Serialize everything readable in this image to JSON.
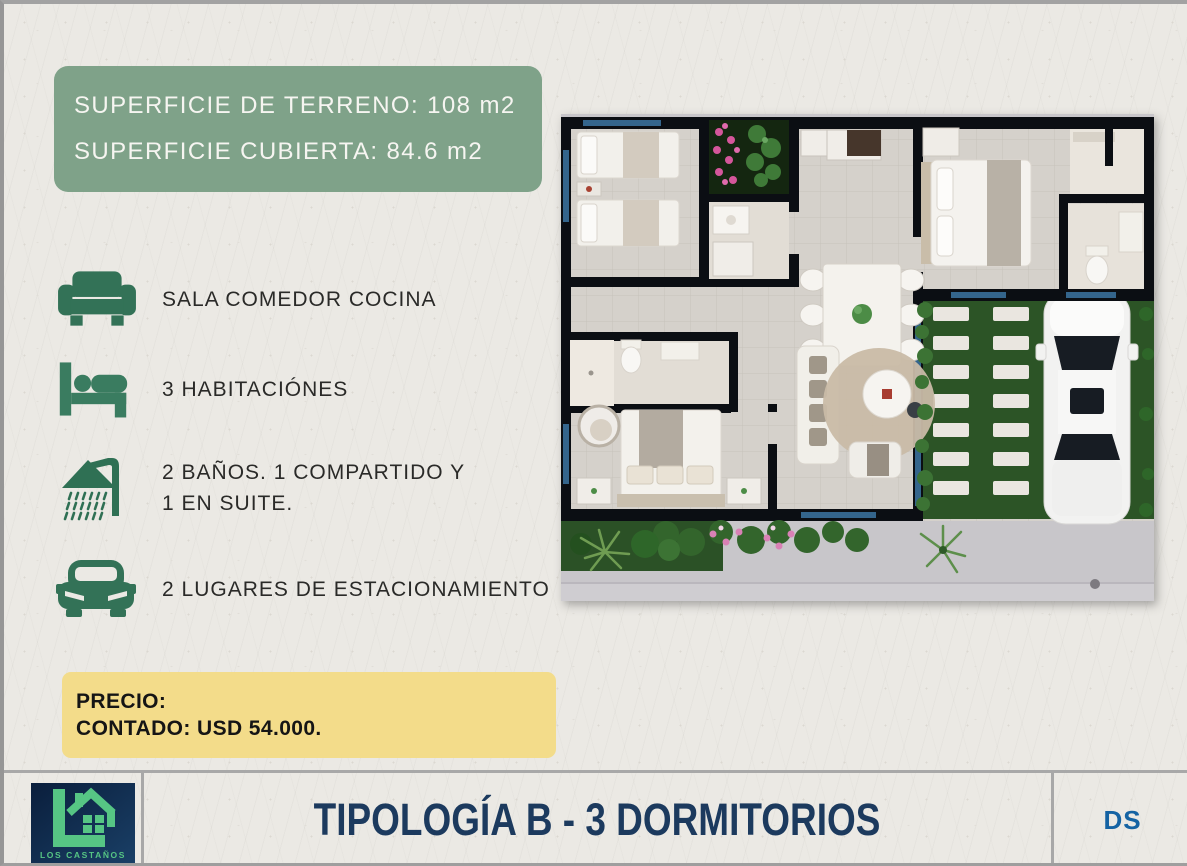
{
  "info_box": {
    "line1": "SUPERFICIE DE TERRENO: 108 m2",
    "line2": "SUPERFICIE CUBIERTA: 84.6 m2"
  },
  "features": [
    {
      "icon": "sofa-icon",
      "lines": [
        "SALA COMEDOR COCINA"
      ]
    },
    {
      "icon": "bed-icon",
      "lines": [
        "3  HABITACIÓNES"
      ]
    },
    {
      "icon": "shower-icon",
      "lines": [
        "2 BAÑOS. 1 COMPARTIDO Y",
        "1 EN SUITE."
      ]
    },
    {
      "icon": "car-icon",
      "lines": [
        "2 LUGARES DE ESTACIONAMIENTO"
      ]
    }
  ],
  "price_box": {
    "label": "PRECIO:",
    "value": "CONTADO: USD 54.000."
  },
  "footer": {
    "title": "TIPOLOGÍA B - 3 DORMITORIOS",
    "badge": "DS",
    "logo_text": "LOS CASTAÑOS"
  },
  "colors": {
    "info_box_green": "#7fa289",
    "icon_green": "#337257",
    "price_yellow": "#f3dc8a",
    "title_navy": "#1c3a5e",
    "badge_blue": "#1563a3",
    "logo_green": "#56c584",
    "logo_navy": "#0a1e3c",
    "paper": "#ebe9e4"
  }
}
